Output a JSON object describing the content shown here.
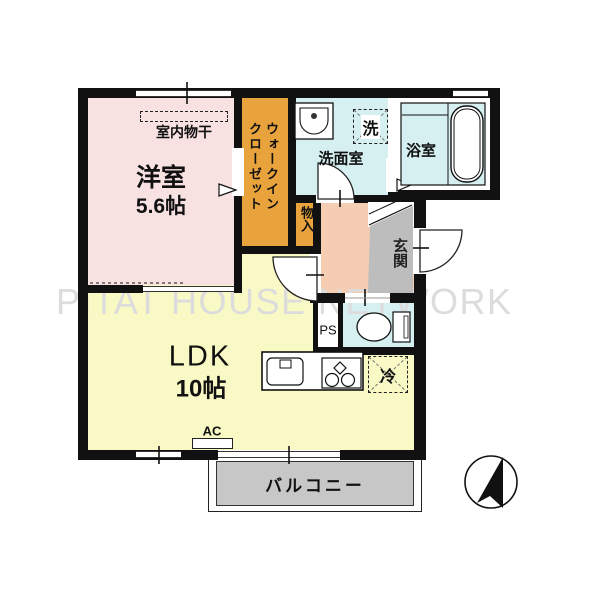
{
  "floor_plan": {
    "watermark": "PITAT HOUSE NETWORK",
    "rooms": {
      "western_room": {
        "name": "洋室",
        "size": "5.6帖",
        "feature": "室内物干"
      },
      "walk_in_closet": {
        "name_line1": "ウォークイン",
        "name_line2": "クローゼット"
      },
      "washroom": {
        "name": "洗面室",
        "washer": "洗"
      },
      "bathroom": {
        "name": "浴室"
      },
      "storage": {
        "name": "物入"
      },
      "entrance": {
        "name": "玄関"
      },
      "pipe_space": {
        "name": "PS"
      },
      "ldk": {
        "name": "LDK",
        "size": "10帖",
        "fridge": "冷",
        "ac": "AC"
      },
      "balcony": {
        "name": "バルコニー"
      }
    },
    "colors": {
      "western_room": "#f8e1e1",
      "closet": "#e8a33c",
      "wet_area": "#d6f0f1",
      "hallway": "#f4cdb2",
      "entrance": "#bdbdbd",
      "ldk": "#f9f9c5",
      "balcony": "#c7c7c7",
      "wall": "#111111"
    }
  }
}
